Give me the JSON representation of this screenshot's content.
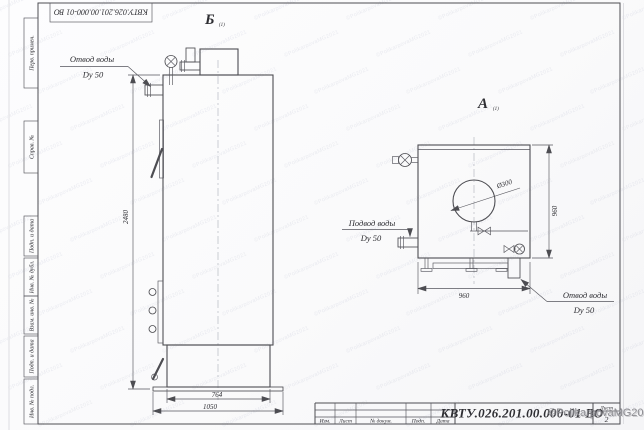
{
  "sheet": {
    "doc_number": "КВТУ.026.201.00.000-01 ВО",
    "margin_stamps": [
      "Перв. примен.",
      "Справ. №",
      "Подп. и дата",
      "Инв. № дубл.",
      "Взам. инв. №",
      "Подп. и дата",
      "Инв. № подл."
    ],
    "title": {
      "columns": [
        "Изм.",
        "Лист",
        "№ докум.",
        "Подп.",
        "Дата"
      ],
      "sheet_label": "Лист",
      "sheet_number": "2"
    }
  },
  "views": {
    "side": {
      "label": "Б",
      "label_note": "(1)",
      "outlet_line1": "Отвод воды",
      "outlet_line2": "Dy 50",
      "dim_height": "2480",
      "dim_body_width": "764",
      "dim_base_width": "1050"
    },
    "front": {
      "label": "А",
      "label_note": "(1)",
      "inlet_line1": "Подвод воды",
      "inlet_line2": "Dy 50",
      "outlet_line1": "Отвод воды",
      "outlet_line2": "Dy 50",
      "dim_diameter": "Ø300",
      "dim_width": "960",
      "dim_height": "960"
    }
  },
  "watermark": {
    "tile_text": "©PolikarpovaMG2021",
    "signature": "©PolikarpovaMG2021"
  },
  "colors": {
    "line": "#4d4d52",
    "dim": "#55555c",
    "centerline": "#abafb8",
    "watermark_tile": "rgba(140,152,178,0.16)",
    "signature": "#8d8d92"
  }
}
